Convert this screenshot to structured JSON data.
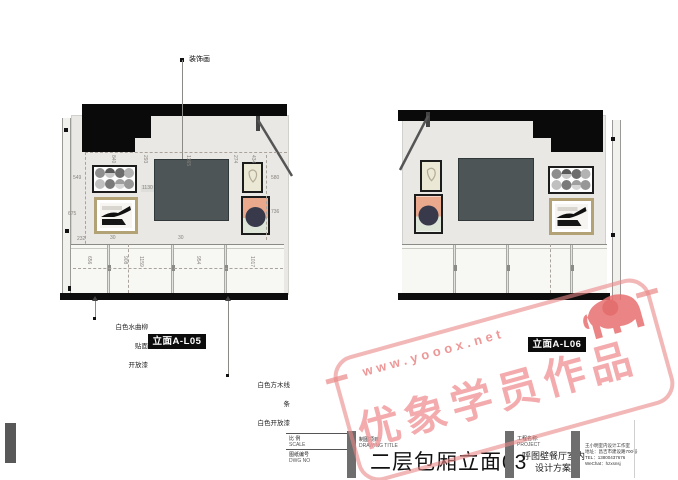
{
  "annotations": {
    "decor_label": "装饰画",
    "left_material_note_1": "白色水曲柳",
    "left_material_note_2": "贴面",
    "left_material_note_3": "开放漆",
    "right_material_note_1": "白色方木线",
    "right_material_note_2": "条",
    "right_material_note_3": "白色开放漆"
  },
  "elevations": {
    "left": {
      "tag": "立面A-L05",
      "dims": {
        "top": [
          "840",
          "293",
          "1365",
          "274",
          "434"
        ],
        "left": [
          "549",
          "675",
          "232"
        ],
        "panel": "1130",
        "right": [
          "580",
          "736"
        ],
        "bottom": [
          "656",
          "908",
          "1159",
          "954",
          "1017"
        ],
        "small_1": "30",
        "small_2": "30"
      }
    },
    "right": {
      "tag": "立面A-L06"
    }
  },
  "watermark": {
    "url": "www.yooox.net",
    "text": "优象学员作品",
    "icon": "elephant-icon",
    "color": "#ed9a9a"
  },
  "titleblock": {
    "scale_label_cn": "比 例",
    "scale_label_en": "SCALE",
    "dwg_label_cn": "图纸编号",
    "dwg_label_en": "DWG NO",
    "drawing_title_label_cn": "制图项目：",
    "drawing_title_label_en": "DRAWING TITLE",
    "drawing_title": "二层包厢立面03",
    "project_label_cn": "工程名称:",
    "project_label_en": "PROJECT",
    "project_name_line1": "呼图壁餐厅室内",
    "project_name_line2": "设计方案",
    "studio_line1": "王小明室内设计工作室",
    "studio_line2": "地址：昌吉市建设路700号",
    "studio_line3": "TEL：13800437676",
    "studio_line4": "WeChat：hzxsnsj"
  },
  "colors": {
    "watermark": "#ed9a9a",
    "tag_bg": "#0c0c0c",
    "ceiling": "#0a0a0a"
  }
}
